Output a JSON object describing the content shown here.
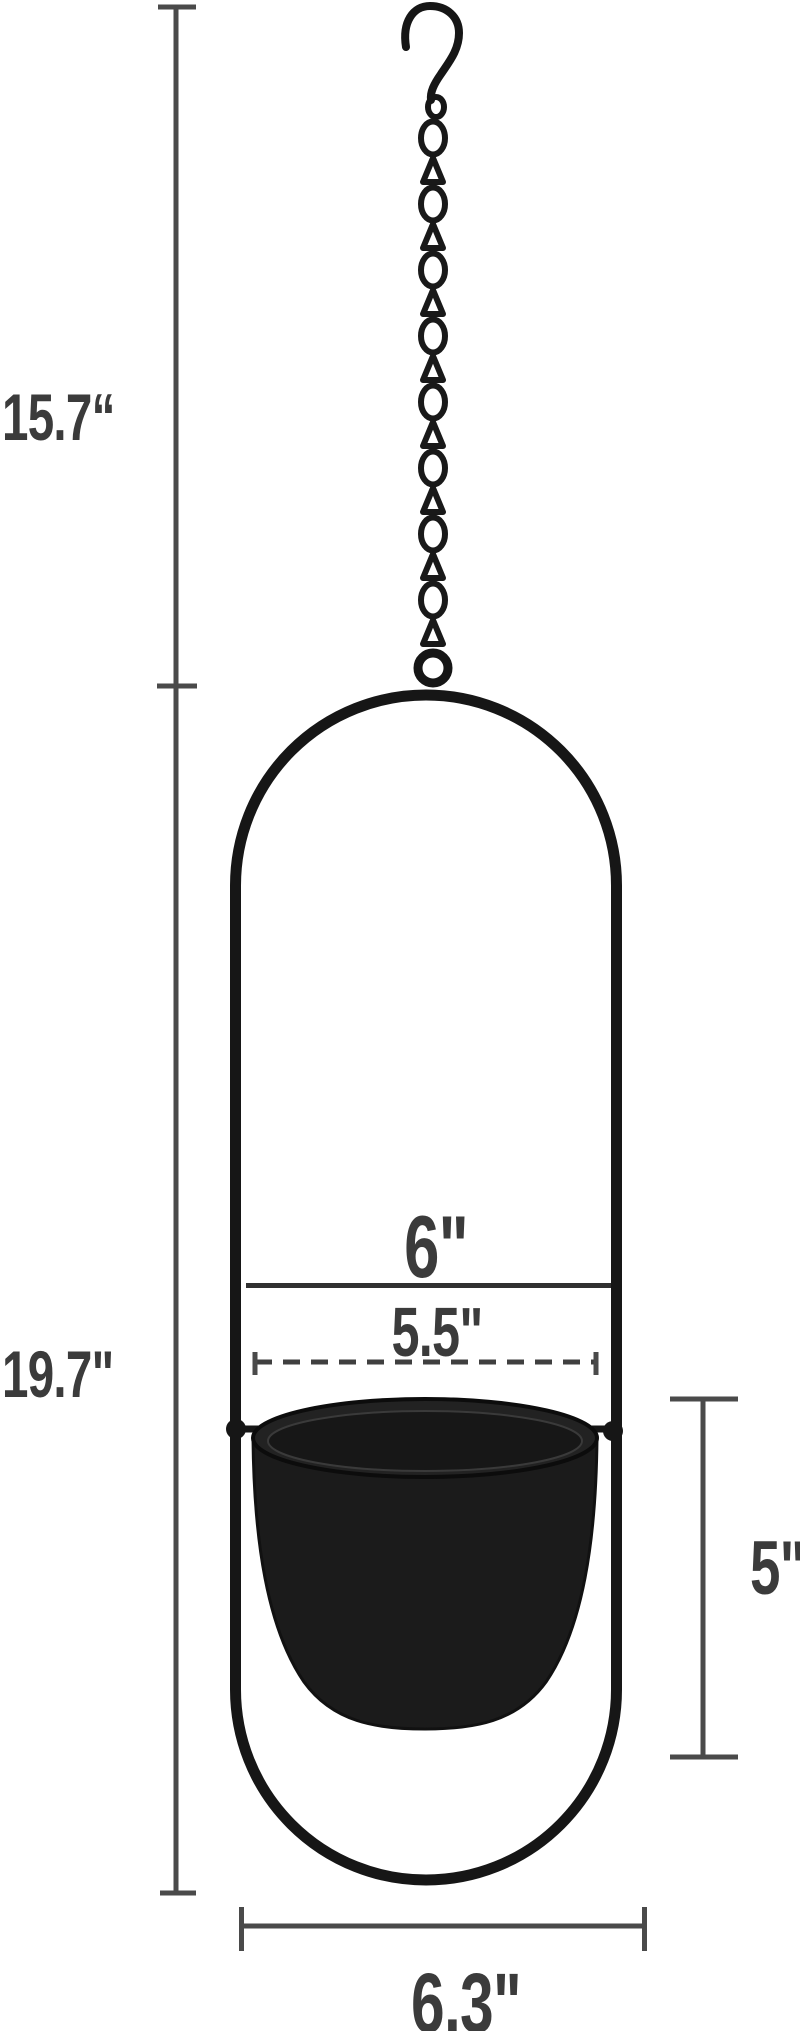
{
  "diagram": {
    "subject": "black hanging planter with chain and oval frame",
    "labels": {
      "chain_length": "15.7“",
      "total_height": "19.7\"",
      "frame_inner_width": "6\"",
      "pot_opening_diameter": "5.5\"",
      "pot_height": "5\"",
      "frame_bottom_width": "6.3\""
    },
    "colors": {
      "background": "#ffffff",
      "product_black": "#161616",
      "dimension_line_gray": "#4a4a4a",
      "label_text_gray": "#3b3b3b"
    }
  }
}
